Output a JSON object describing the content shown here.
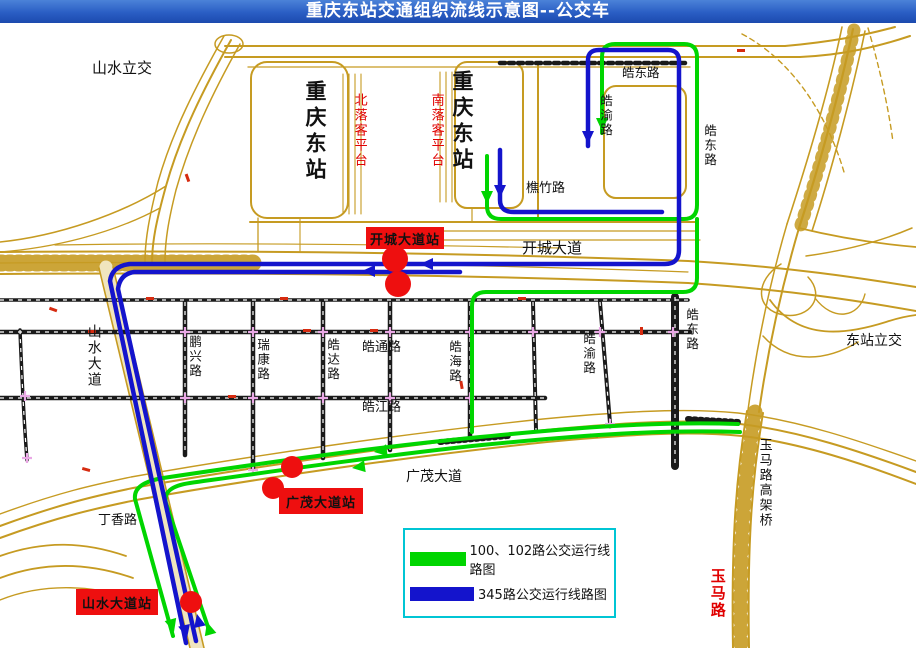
{
  "title": "重庆东站交通组织流线示意图--公交车",
  "colors": {
    "title_bar": "#2a5ec4",
    "route_green": "#00d500",
    "route_blue": "#1414cc",
    "road": "#c69b22",
    "station_red": "#ee0f0f",
    "label_red": "#e00000",
    "legend_border": "#00c5d4",
    "intersection_pink": "#e9a8e5"
  },
  "map_labels": {
    "shanshui_interchange": "山水立交",
    "station_left": "重庆东站",
    "north_platform": "北落客平台",
    "south_platform": "南落客平台",
    "station_right": "重庆东站",
    "haodong_top": "皓东路",
    "haoyu_top": "皓渝路",
    "haodong_upper_right": "皓东路",
    "qiaozhu_road": "樵竹路",
    "kaicheng_avenue": "开城大道",
    "dongzhan_interchange": "东站立交",
    "haodong_mid": "皓东路",
    "shanshui_avenue": "山水大道",
    "pengxing_road": "鹏兴路",
    "ruikang_road": "瑞康路",
    "haoda_road": "皓达路",
    "haotong_road": "皓通路",
    "haohai_road": "皓海路",
    "haojiang_road": "皓江路",
    "haoyu_mid": "皓渝路",
    "guangmao_avenue": "广茂大道",
    "dingxiang_road": "丁香路",
    "yuma_viaduct": "玉马路高架桥",
    "yuma_road": "玉马路"
  },
  "stations": {
    "kaicheng": "开城大道站",
    "guangmao": "广茂大道站",
    "shanshui": "山水大道站"
  },
  "legend": {
    "green_label": "100、102路公交运行线路图",
    "blue_label": "345路公交运行线路图"
  }
}
